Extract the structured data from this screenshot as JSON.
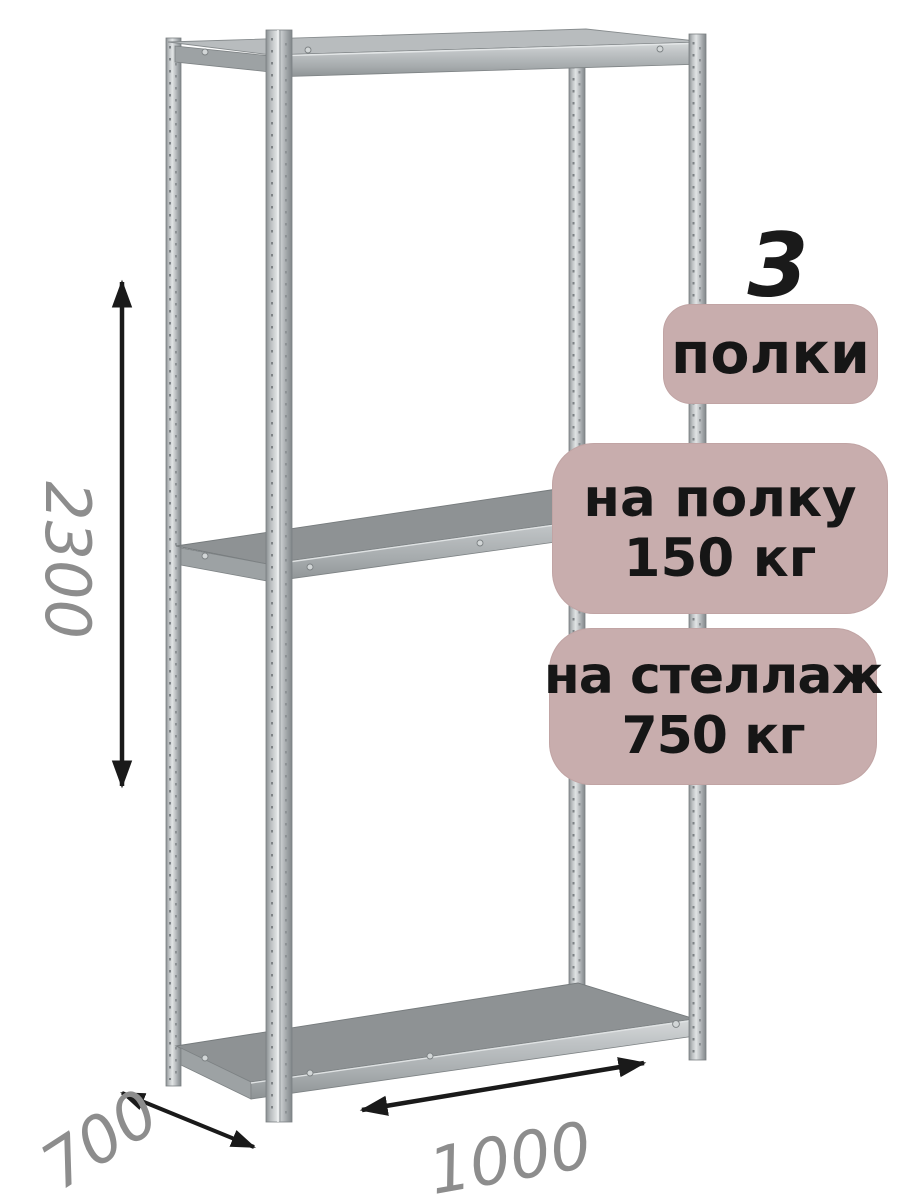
{
  "product": {
    "type": "metal-shelving-rack",
    "shelf_count": {
      "number": "3",
      "label": "полки"
    },
    "per_shelf_load": {
      "line1": "на полку",
      "line2": "150 кг"
    },
    "per_rack_load": {
      "line1": "на стеллаж",
      "line2": "750 кг"
    }
  },
  "dimensions": {
    "height_mm": "2300",
    "depth_mm": "700",
    "width_mm": "1000"
  },
  "colors": {
    "badge_background": "#c8adad",
    "badge_text": "#161616",
    "dimension_text": "#8d8d8d",
    "arrow": "#1a1a1a",
    "metal_light": "#dfe2e3",
    "metal_mid": "#b2b6b8",
    "metal_dark": "#8e9294",
    "page_background": "#ffffff"
  }
}
